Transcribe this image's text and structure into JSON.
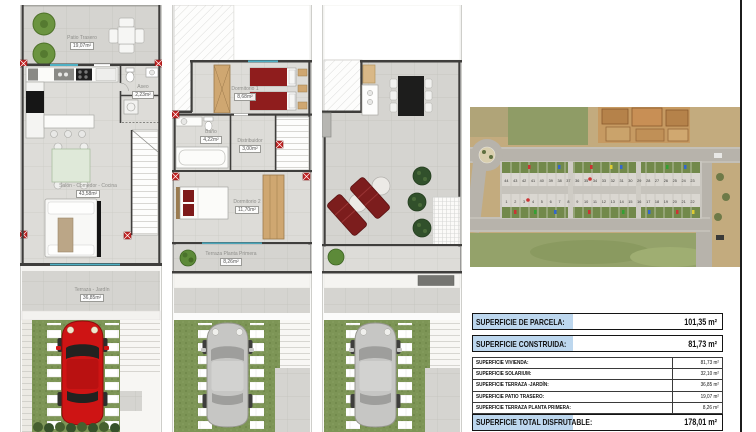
{
  "sheet": {
    "background": "#ffffff",
    "frame_color": "#1c1c1c"
  },
  "colors": {
    "table_highlight_blue": "#bdd7ee",
    "grass_green": "#7d9556",
    "tile_gray": "#d5d4d0",
    "car_red": "#ce1414",
    "bed_red": "#8f1d1d",
    "pillar_marker_red": "#c32222",
    "window_glass_teal": "#4fb0c4",
    "wood_tan": "#cfa771"
  },
  "plans": {
    "ground_floor": {
      "rooms": {
        "patio": {
          "name": "Patio Trasero",
          "area": "19,07m²"
        },
        "aseo": {
          "name": "Aseo",
          "area": "2,23m²"
        },
        "salon": {
          "name": "Salón - Comedor - Cocina",
          "area": "43,58m²"
        },
        "terraza": {
          "name": "Terraza - Jardín",
          "area": "36,85m²"
        }
      }
    },
    "first_floor": {
      "rooms": {
        "dormitorio1": {
          "name": "Dormitorio 1",
          "area": "8,68m²"
        },
        "bano": {
          "name": "Baño",
          "area": "4,22m²"
        },
        "distribuidor": {
          "name": "Distribuidor",
          "area": "3,00m²"
        },
        "dormitorio2": {
          "name": "Dormitorio 2",
          "area": "11,70m²"
        },
        "terraza_p1": {
          "name": "Terraza Planta Primera",
          "area": "8,26m²"
        }
      }
    },
    "solarium": {
      "rooms": {}
    }
  },
  "site_plan": {
    "lot_numbers_top": [
      "44",
      "43",
      "42",
      "41",
      "40",
      "39",
      "38",
      "37",
      "36",
      "35",
      "34",
      "33",
      "32",
      "31",
      "30",
      "29",
      "28",
      "27",
      "26",
      "25",
      "24",
      "23"
    ],
    "lot_numbers_bottom": [
      "1",
      "2",
      "3",
      "4",
      "5",
      "6",
      "7",
      "8",
      "9",
      "10",
      "11",
      "12",
      "13",
      "14",
      "15",
      "16",
      "17",
      "18",
      "19",
      "20",
      "21",
      "22"
    ]
  },
  "areas_table": {
    "rows_primary": [
      {
        "label": "SUPERFICIE DE PARCELA:",
        "value": "101,35 m²"
      },
      {
        "label": "SUPERFICIE CONSTRUIDA:",
        "value": "81,73 m²"
      }
    ],
    "rows_detail": [
      {
        "label": "SUPERFICIE VIVIENDA:",
        "value": "81,73 m²"
      },
      {
        "label": "SUPERFICIE SOLARIUM:",
        "value": "32,10 m²"
      },
      {
        "label": "SUPERFICIE TERRAZA -JARDÍN:",
        "value": "36,85 m²"
      },
      {
        "label": "SUPERFICIE PATIO TRASERO:",
        "value": "19,07 m²"
      },
      {
        "label": "SUPERFICIE TERRAZA PLANTA PRIMERA:",
        "value": "8,26 m²"
      }
    ],
    "row_total": {
      "label": "SUPERFICIE TOTAL DISFRUTABLE:",
      "value": "178,01 m²"
    }
  }
}
